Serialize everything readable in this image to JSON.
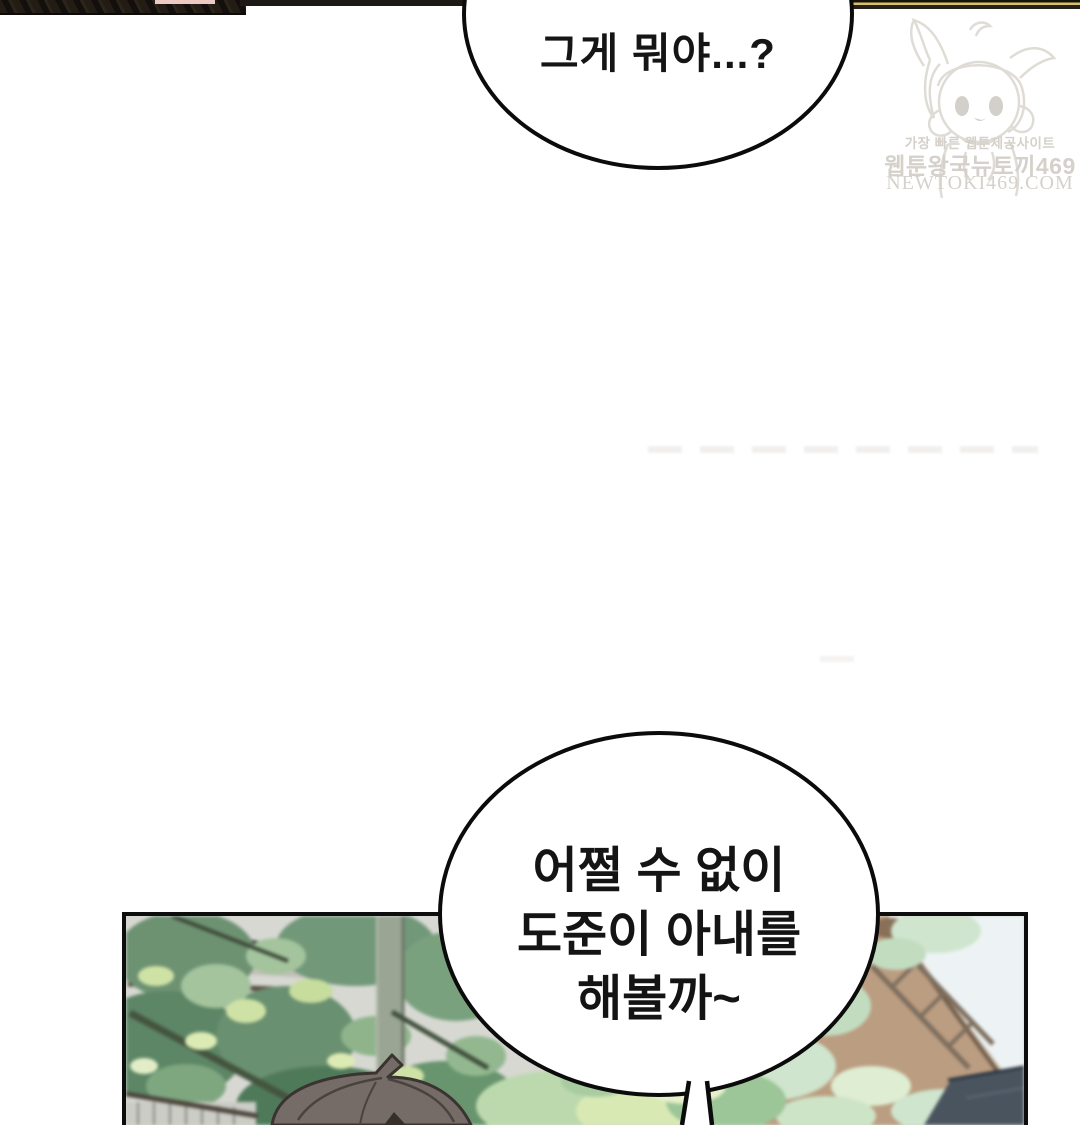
{
  "page": {
    "kind": "webtoon comic page"
  },
  "speech": {
    "top": {
      "text": "그게 뭐야...?"
    },
    "bottom": {
      "lines": [
        "어쩔 수 없이",
        "도준이 아내를",
        "해볼까~"
      ]
    }
  },
  "watermark": {
    "tagline": "가장 빠른 웹툰제공사이트",
    "site_name": "웹툰왕국뉴토끼469",
    "domain": "NEWTOKI469.COM"
  },
  "colors": {
    "bubble_outline": "#0b0b0b",
    "panel_border": "#0d0d0d",
    "strip_dark": "#16120e",
    "strip_gold": "#d6c06a",
    "strip_pink": "#ecc9c2",
    "watermark_gray": "#d5d1ca",
    "foliage_green": "#6e9a74",
    "foliage_highlight": "#cfe2a6",
    "building_gray": "#d7d8d2",
    "roof_tan": "#bb9d81",
    "sky": "#edf3f4",
    "hair_gray": "#756c68",
    "dark_roof_blue": "#49545f"
  }
}
